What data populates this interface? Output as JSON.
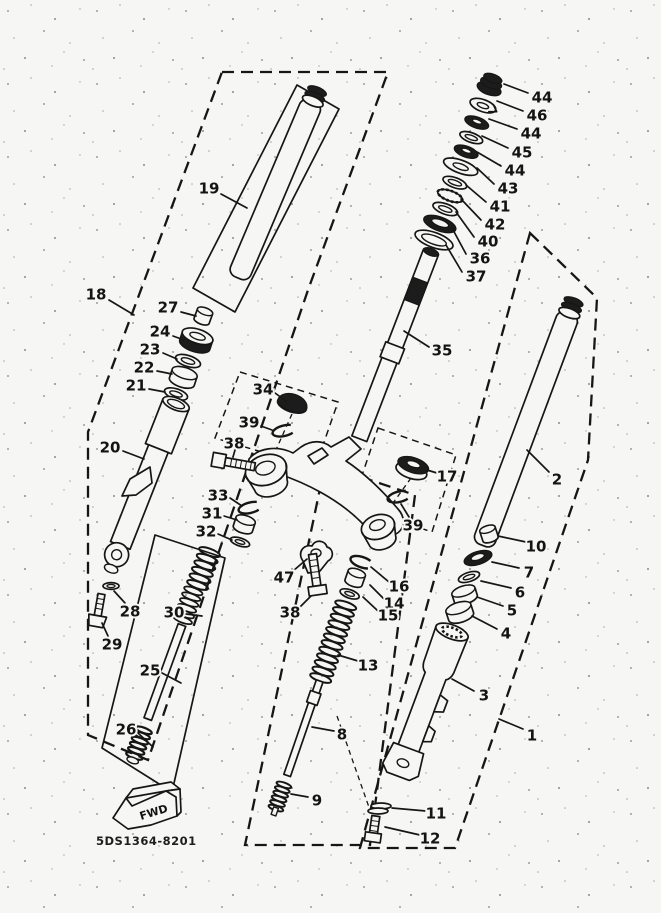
{
  "colors": {
    "paper": "#f6f6f4",
    "ink": "#161616"
  },
  "footer": {
    "fwd_label": "FWD",
    "diagram_code": "5DS1364-8201"
  },
  "part_labels": [
    {
      "text": "44",
      "x": 542,
      "y": 97,
      "leader": [
        528,
        93,
        504,
        84
      ]
    },
    {
      "text": "46",
      "x": 537,
      "y": 115,
      "leader": [
        523,
        111,
        497,
        101
      ]
    },
    {
      "text": "44",
      "x": 531,
      "y": 133,
      "leader": [
        517,
        129,
        489,
        119
      ]
    },
    {
      "text": "45",
      "x": 522,
      "y": 152,
      "leader": [
        508,
        148,
        482,
        136
      ]
    },
    {
      "text": "44",
      "x": 515,
      "y": 170,
      "leader": [
        501,
        166,
        477,
        152
      ]
    },
    {
      "text": "43",
      "x": 508,
      "y": 188,
      "leader": [
        494,
        184,
        477,
        168
      ]
    },
    {
      "text": "41",
      "x": 500,
      "y": 206,
      "leader": [
        486,
        202,
        466,
        185
      ]
    },
    {
      "text": "42",
      "x": 495,
      "y": 224,
      "leader": [
        481,
        220,
        461,
        199
      ]
    },
    {
      "text": "40",
      "x": 488,
      "y": 241,
      "leader": [
        474,
        237,
        456,
        212
      ]
    },
    {
      "text": "36",
      "x": 480,
      "y": 258,
      "leader": [
        466,
        254,
        452,
        228
      ]
    },
    {
      "text": "37",
      "x": 476,
      "y": 276,
      "leader": [
        462,
        272,
        446,
        245
      ]
    },
    {
      "text": "35",
      "x": 442,
      "y": 350,
      "leader": [
        429,
        347,
        404,
        331
      ]
    },
    {
      "text": "2",
      "x": 557,
      "y": 479,
      "leader": [
        549,
        472,
        527,
        450
      ]
    },
    {
      "text": "19",
      "x": 209,
      "y": 188,
      "leader": [
        221,
        194,
        247,
        208
      ]
    },
    {
      "text": "18",
      "x": 96,
      "y": 294,
      "leader": [
        109,
        300,
        134,
        315
      ]
    },
    {
      "text": "27",
      "x": 168,
      "y": 307,
      "leader": [
        181,
        312,
        196,
        316
      ]
    },
    {
      "text": "24",
      "x": 160,
      "y": 331,
      "leader": [
        173,
        336,
        184,
        340
      ]
    },
    {
      "text": "23",
      "x": 150,
      "y": 349,
      "leader": [
        163,
        353,
        177,
        359
      ]
    },
    {
      "text": "22",
      "x": 144,
      "y": 367,
      "leader": [
        157,
        371,
        172,
        374
      ]
    },
    {
      "text": "21",
      "x": 136,
      "y": 385,
      "leader": [
        149,
        389,
        165,
        392
      ]
    },
    {
      "text": "20",
      "x": 110,
      "y": 447,
      "leader": [
        123,
        451,
        144,
        459
      ]
    },
    {
      "text": "34",
      "x": 263,
      "y": 389,
      "leader": [
        275,
        393,
        286,
        401
      ]
    },
    {
      "text": "39",
      "x": 249,
      "y": 422,
      "leader": [
        261,
        426,
        272,
        430
      ]
    },
    {
      "text": "38",
      "x": 234,
      "y": 443,
      "leader": [
        235,
        450,
        233,
        457
      ]
    },
    {
      "text": "33",
      "x": 218,
      "y": 495,
      "leader": [
        230,
        498,
        242,
        506
      ]
    },
    {
      "text": "31",
      "x": 212,
      "y": 513,
      "leader": [
        224,
        516,
        237,
        520
      ]
    },
    {
      "text": "32",
      "x": 206,
      "y": 531,
      "leader": [
        218,
        534,
        232,
        540
      ]
    },
    {
      "text": "17",
      "x": 447,
      "y": 476,
      "leader": [
        437,
        473,
        427,
        470
      ]
    },
    {
      "text": "39",
      "x": 413,
      "y": 525,
      "leader": [
        409,
        517,
        401,
        504
      ]
    },
    {
      "text": "47",
      "x": 284,
      "y": 577,
      "leader": [
        293,
        571,
        307,
        559
      ]
    },
    {
      "text": "38",
      "x": 290,
      "y": 612,
      "leader": [
        300,
        607,
        311,
        596
      ]
    },
    {
      "text": "16",
      "x": 399,
      "y": 586,
      "leader": [
        389,
        582,
        371,
        567
      ]
    },
    {
      "text": "14",
      "x": 394,
      "y": 603,
      "leader": [
        384,
        599,
        370,
        585
      ]
    },
    {
      "text": "15",
      "x": 388,
      "y": 615,
      "leader": [
        378,
        611,
        363,
        597
      ]
    },
    {
      "text": "13",
      "x": 368,
      "y": 665,
      "leader": [
        358,
        661,
        338,
        655
      ]
    },
    {
      "text": "8",
      "x": 342,
      "y": 734,
      "leader": [
        334,
        731,
        312,
        727
      ]
    },
    {
      "text": "3",
      "x": 484,
      "y": 695,
      "leader": [
        474,
        691,
        452,
        679
      ]
    },
    {
      "text": "9",
      "x": 317,
      "y": 800,
      "leader": [
        308,
        797,
        291,
        794
      ]
    },
    {
      "text": "11",
      "x": 436,
      "y": 813,
      "leader": [
        426,
        811,
        392,
        808
      ]
    },
    {
      "text": "12",
      "x": 430,
      "y": 838,
      "leader": [
        420,
        835,
        385,
        827
      ]
    },
    {
      "text": "1",
      "x": 532,
      "y": 735,
      "leader": [
        523,
        729,
        499,
        719
      ]
    },
    {
      "text": "10",
      "x": 536,
      "y": 546,
      "leader": [
        526,
        542,
        498,
        536
      ]
    },
    {
      "text": "7",
      "x": 529,
      "y": 572,
      "leader": [
        519,
        568,
        492,
        562
      ]
    },
    {
      "text": "6",
      "x": 520,
      "y": 592,
      "leader": [
        511,
        588,
        481,
        581
      ]
    },
    {
      "text": "5",
      "x": 512,
      "y": 610,
      "leader": [
        503,
        606,
        477,
        597
      ]
    },
    {
      "text": "4",
      "x": 506,
      "y": 633,
      "leader": [
        497,
        629,
        472,
        616
      ]
    },
    {
      "text": "30",
      "x": 174,
      "y": 612,
      "leader": [
        186,
        614,
        202,
        616
      ]
    },
    {
      "text": "25",
      "x": 150,
      "y": 670,
      "leader": [
        162,
        673,
        181,
        683
      ]
    },
    {
      "text": "26",
      "x": 126,
      "y": 729,
      "leader": [
        138,
        733,
        153,
        747
      ]
    },
    {
      "text": "28",
      "x": 130,
      "y": 611,
      "leader": [
        125,
        603,
        114,
        591
      ]
    },
    {
      "text": "29",
      "x": 112,
      "y": 644,
      "leader": [
        108,
        636,
        102,
        623
      ]
    }
  ]
}
